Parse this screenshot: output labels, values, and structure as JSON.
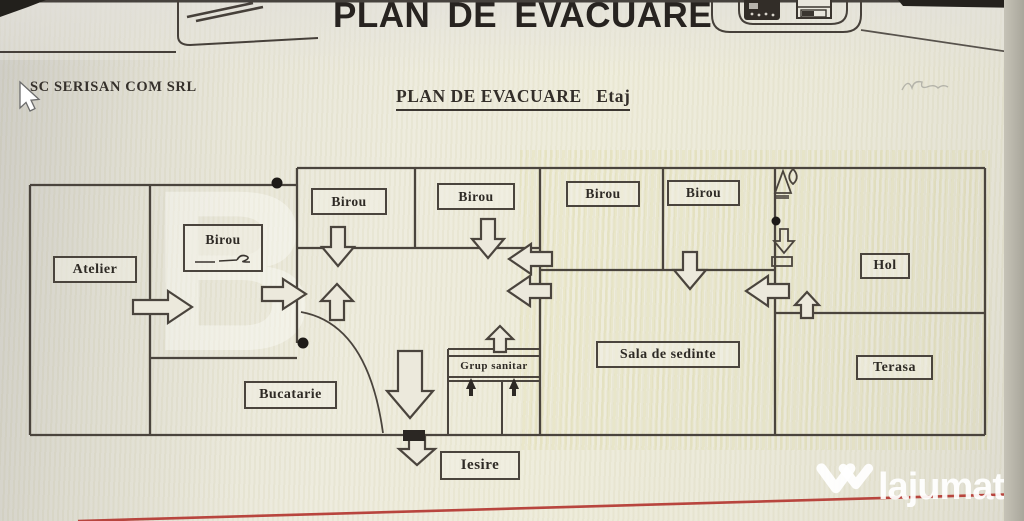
{
  "photo_header": {
    "main_title": "PLAN DE EVACUARE"
  },
  "document": {
    "company": "SC SERISAN COM SRL",
    "subtitle": "PLAN DE EVACUARE   Etaj"
  },
  "plan": {
    "rooms": {
      "atelier": "Atelier",
      "birou": "Birou",
      "bucatarie": "Bucatarie",
      "grup_sanitar": "Grup sanitar",
      "sala_de_sedinte": "Sala de sedinte",
      "hol": "Hol",
      "terasa": "Terasa",
      "iesire": "Iesire"
    }
  },
  "watermark": {
    "brand": "lajumate",
    "tld": ".ro",
    "background_letter": "B"
  },
  "colors": {
    "wall": "#4a443d",
    "paper": "#ece9dc",
    "red_line": "#b8453e",
    "watermark_teal": "#3fbccb"
  }
}
